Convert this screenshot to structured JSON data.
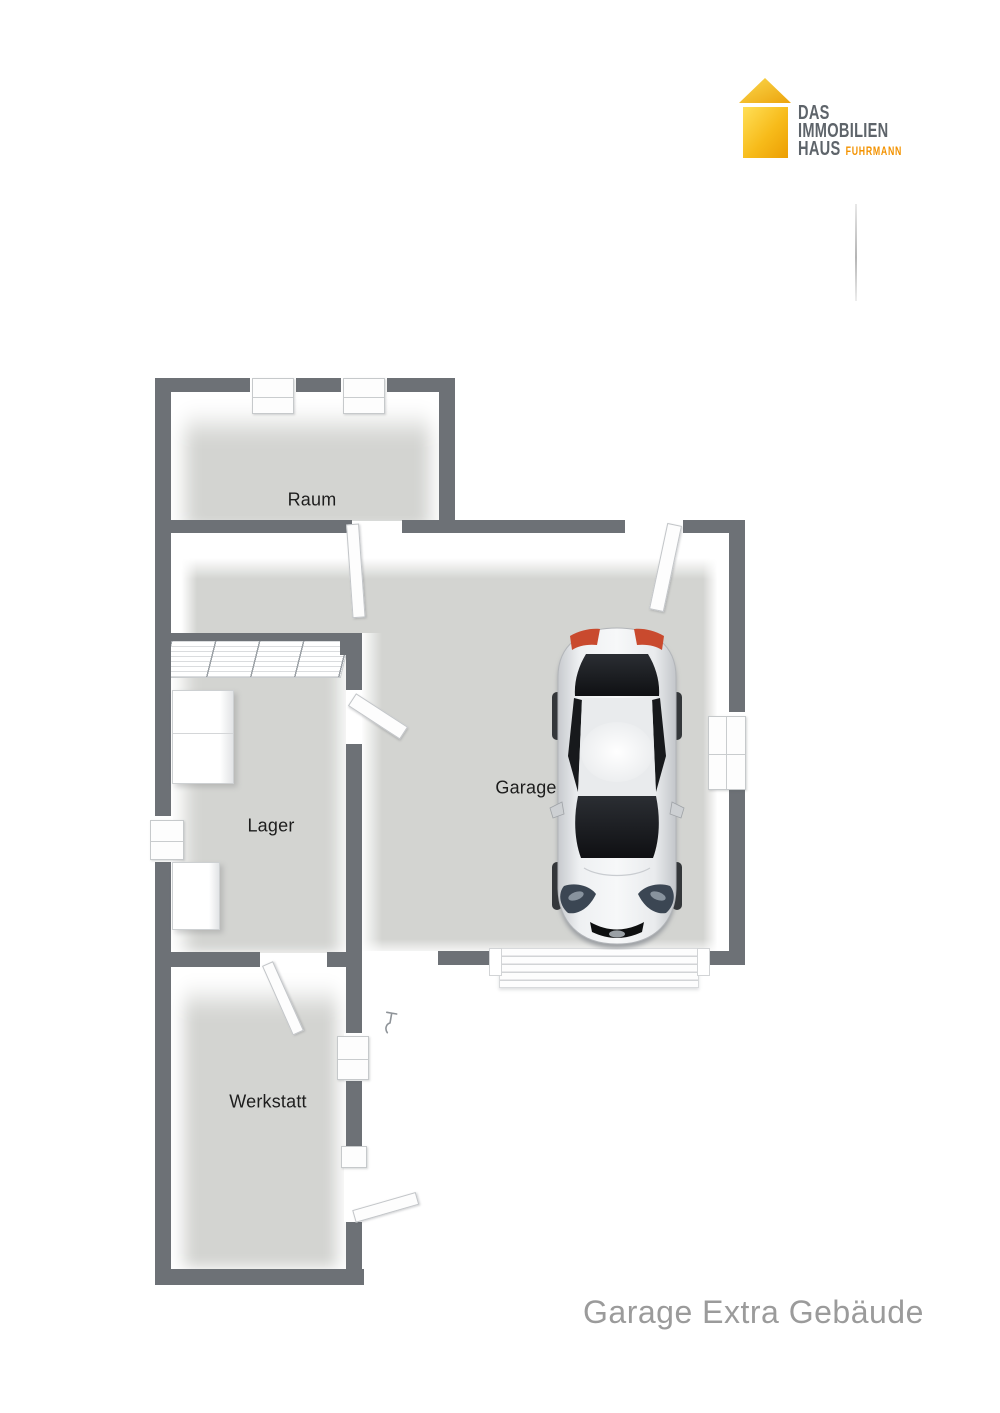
{
  "logo": {
    "line1": "DAS",
    "line2": "IMMOBILIEN",
    "line3": "HAUS",
    "sub": "FUHRMANN"
  },
  "rooms": [
    {
      "id": "raum",
      "label": "Raum"
    },
    {
      "id": "lager",
      "label": "Lager"
    },
    {
      "id": "garage",
      "label": "Garage"
    },
    {
      "id": "werkstatt",
      "label": "Werkstatt"
    }
  ],
  "caption": "Garage Extra Gebäude",
  "icons": {
    "brand": "house-icon",
    "vehicle": "car-top-view",
    "outdoor_fixture": "outdoor-tap-icon"
  },
  "colors": {
    "wall": "#6d7176",
    "floor": "#d3d4d1",
    "label": "#1d1d1d",
    "caption": "#9b9b9b",
    "logo_text": "#5e646a",
    "logo_sub": "#f39200",
    "logo_roof_from": "#f9cf3d",
    "logo_roof_to": "#eca30c",
    "logo_body_from": "#ffdf57",
    "logo_body_to": "#ec9e03",
    "door_face": "#fdfdfd",
    "door_edge": "#c2c5c8",
    "window_edge": "#c6c9cb",
    "car_body": "#eef0f2",
    "car_glass": "#141518",
    "car_taillight": "#c94a2e",
    "car_headlight": "#3b4653"
  }
}
